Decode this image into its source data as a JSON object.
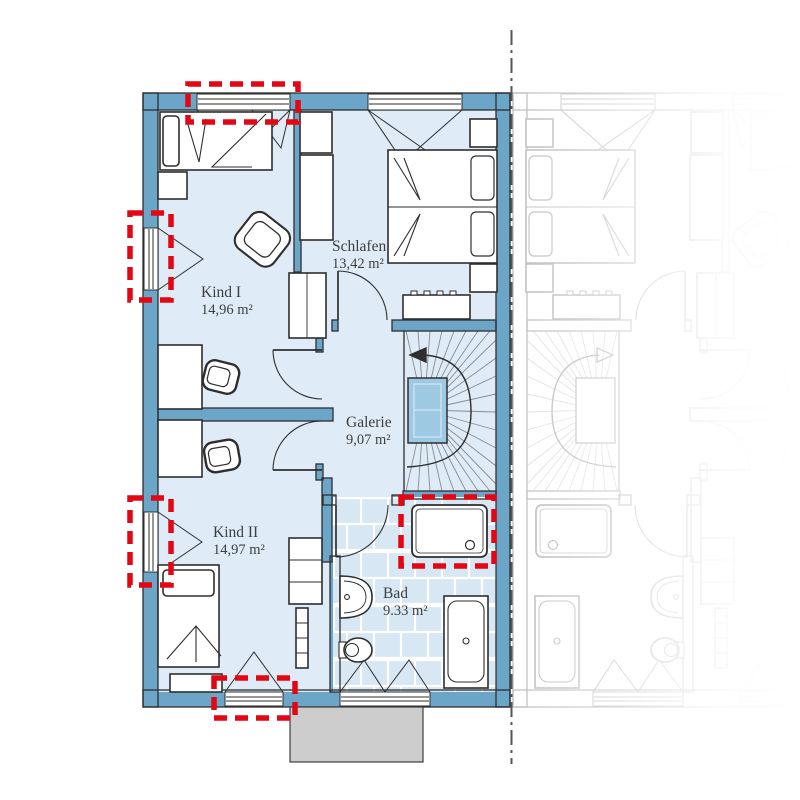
{
  "floorplan": {
    "rooms": [
      {
        "name": "Kind I",
        "area": "14,96 m²"
      },
      {
        "name": "Schlafen",
        "area": "13,42 m²"
      },
      {
        "name": "Galerie",
        "area": "9,07 m²"
      },
      {
        "name": "Kind II",
        "area": "14,97 m²"
      },
      {
        "name": "Bad",
        "area": "9.33 m²"
      }
    ],
    "colors": {
      "wall": "#6ba6c9",
      "floor": "#dfecf7",
      "stair_void": "#9ec9e3",
      "highlight": "#e30613",
      "terrace": "#cbcccb",
      "ghost": "#b3b3b3"
    }
  }
}
